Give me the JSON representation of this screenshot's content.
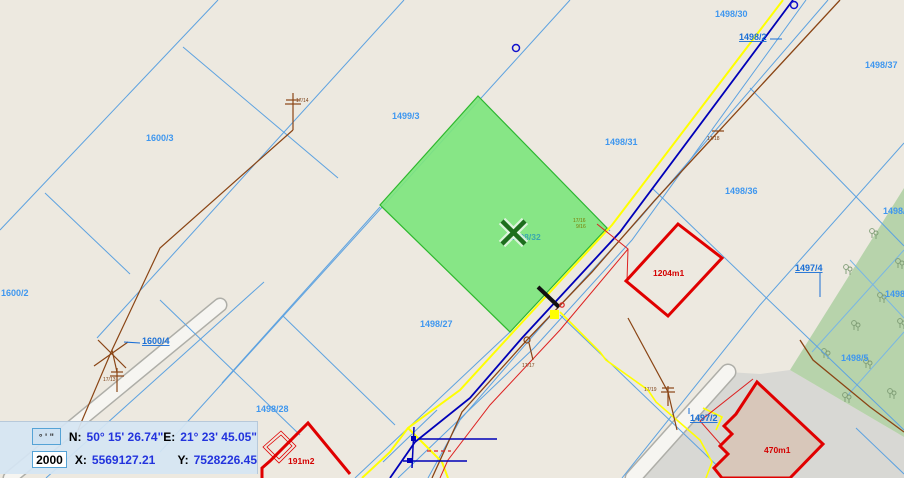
{
  "map": {
    "selected_parcel_id": "1498/32",
    "parcel_labels": [
      {
        "text": "1600/3"
      },
      {
        "text": "1499/3"
      },
      {
        "text": "1498/30"
      },
      {
        "text": "1498/2"
      },
      {
        "text": "1498/37"
      },
      {
        "text": "1498/31"
      },
      {
        "text": "1498/36"
      },
      {
        "text": "1498/32"
      },
      {
        "text": "1498/27"
      },
      {
        "text": "1498/28"
      },
      {
        "text": "1600/2"
      },
      {
        "text": "1600/4"
      },
      {
        "text": "1497/4"
      },
      {
        "text": "1497/2"
      },
      {
        "text": "1498/3"
      },
      {
        "text": "1498/1"
      },
      {
        "text": "1498/5"
      }
    ],
    "building_labels": [
      {
        "text": "1204m1"
      },
      {
        "text": "470m1"
      },
      {
        "text": "191m2"
      }
    ],
    "pole_labels": [
      {
        "text": "17/14"
      },
      {
        "text": "17/13"
      },
      {
        "text": "17/18"
      },
      {
        "text": "17/17"
      },
      {
        "text": "17/19"
      },
      {
        "text": "17/16"
      },
      {
        "text": "9/16"
      }
    ],
    "colors": {
      "background": "#ede9e0",
      "parcel_line": "#5da2e0",
      "selected_parcel_fill": "#7ee57e",
      "selection_marker": "#1d6e1d",
      "road_yellow": "#ffff00",
      "utility_blue": "#0000b8",
      "utility_brown": "#8a4515",
      "building_red": "#e00000",
      "forest_green": "#b7d3ab",
      "pavement_gray": "#d8d8d4"
    }
  },
  "status_bar": {
    "dms_button": "° ' \"",
    "scale": "2000",
    "n_label": "N:",
    "n_value": "50° 15' 26.74\"",
    "e_label": "E:",
    "e_value": "21° 23' 45.05\"",
    "x_label": "X:",
    "x_value": "5569127.21",
    "y_label": "Y:",
    "y_value": "7528226.45"
  }
}
